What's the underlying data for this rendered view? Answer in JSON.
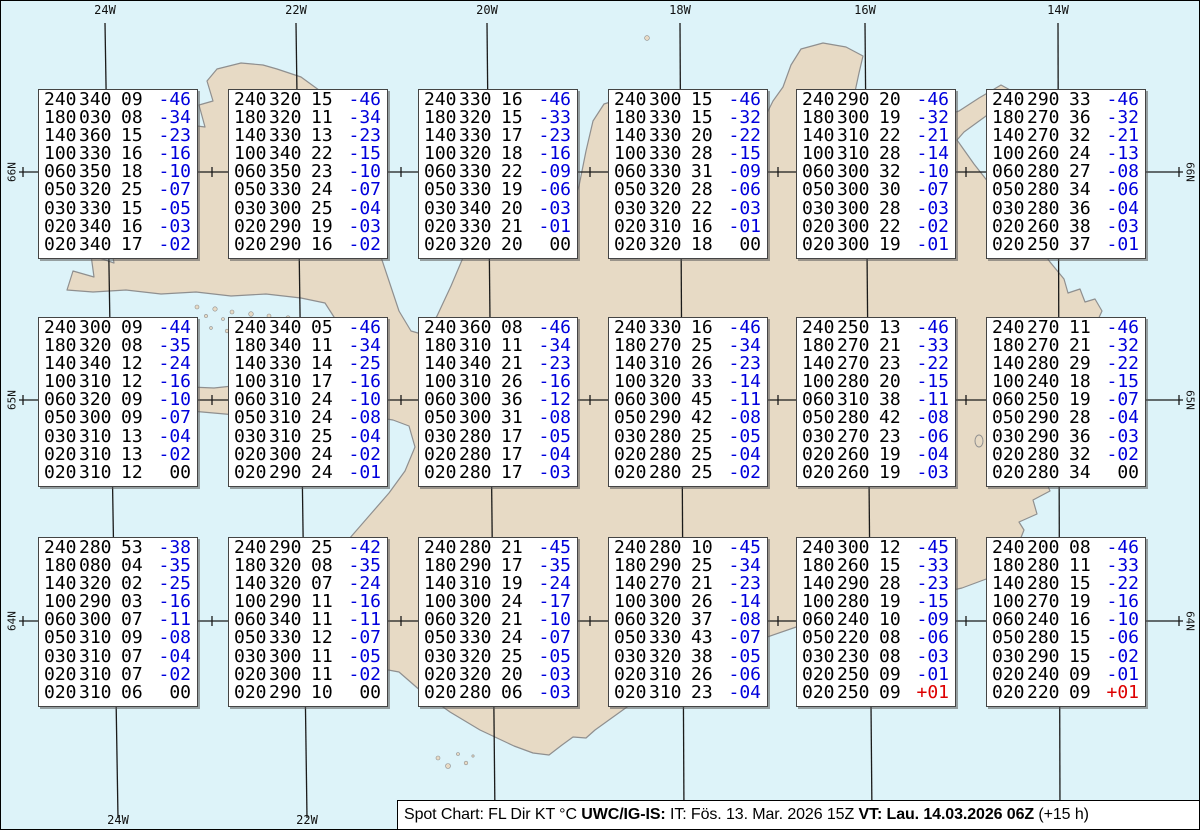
{
  "title": "Spot Chart: FL Dir KT °C",
  "colors": {
    "ocean": "#ddf3f9",
    "land": "#e7dac5",
    "coast": "#8f8f8f",
    "graticule": "#1a1a1a",
    "temp_negative": "#0000dd",
    "temp_positive": "#dd0000",
    "box_background": "#ffffff"
  },
  "graticule_labels": {
    "top": [
      "24W",
      "22W",
      "20W",
      "18W",
      "16W",
      "14W"
    ],
    "bottom": [
      "24W",
      "22W"
    ],
    "left": [
      "66N",
      "65N",
      "64N"
    ],
    "right": [
      "66N",
      "65N",
      "64N"
    ]
  },
  "status_bar": {
    "segments": [
      {
        "text": "Spot Chart: FL Dir KT °C ",
        "bold": false
      },
      {
        "text": "UWC/IG-IS:",
        "bold": true
      },
      {
        "text": " IT: Fös. 13. Mar. 2026 15Z ",
        "bold": false
      },
      {
        "text": "VT: Lau. 14.03.2026 06Z",
        "bold": true
      },
      {
        "text": " (+15 h)",
        "bold": false
      }
    ]
  },
  "chart_data": {
    "type": "table",
    "title": "Spot Chart: FL Dir KT °C",
    "columns": [
      "FL",
      "Dir",
      "KT",
      "TempC"
    ],
    "grid": {
      "columns": 6,
      "rows": 3
    },
    "spots": [
      {
        "lines": [
          [
            "240",
            "340",
            "09",
            "-46"
          ],
          [
            "180",
            "030",
            "08",
            "-34"
          ],
          [
            "140",
            "360",
            "15",
            "-23"
          ],
          [
            "100",
            "330",
            "16",
            "-16"
          ],
          [
            "060",
            "350",
            "18",
            "-10"
          ],
          [
            "050",
            "320",
            "25",
            "-07"
          ],
          [
            "030",
            "330",
            "15",
            "-05"
          ],
          [
            "020",
            "340",
            "16",
            "-03"
          ],
          [
            "020",
            "340",
            "17",
            "-02"
          ]
        ]
      },
      {
        "lines": [
          [
            "240",
            "320",
            "15",
            "-46"
          ],
          [
            "180",
            "320",
            "11",
            "-34"
          ],
          [
            "140",
            "330",
            "13",
            "-23"
          ],
          [
            "100",
            "340",
            "22",
            "-15"
          ],
          [
            "060",
            "350",
            "23",
            "-10"
          ],
          [
            "050",
            "330",
            "24",
            "-07"
          ],
          [
            "030",
            "300",
            "25",
            "-04"
          ],
          [
            "020",
            "290",
            "19",
            "-03"
          ],
          [
            "020",
            "290",
            "16",
            "-02"
          ]
        ]
      },
      {
        "lines": [
          [
            "240",
            "330",
            "16",
            "-46"
          ],
          [
            "180",
            "320",
            "15",
            "-33"
          ],
          [
            "140",
            "330",
            "17",
            "-23"
          ],
          [
            "100",
            "320",
            "18",
            "-16"
          ],
          [
            "060",
            "330",
            "22",
            "-09"
          ],
          [
            "050",
            "330",
            "19",
            "-06"
          ],
          [
            "030",
            "340",
            "20",
            "-03"
          ],
          [
            "020",
            "330",
            "21",
            "-01"
          ],
          [
            "020",
            "320",
            "20",
            "00"
          ]
        ]
      },
      {
        "lines": [
          [
            "240",
            "300",
            "15",
            "-46"
          ],
          [
            "180",
            "330",
            "15",
            "-32"
          ],
          [
            "140",
            "330",
            "20",
            "-22"
          ],
          [
            "100",
            "330",
            "28",
            "-15"
          ],
          [
            "060",
            "330",
            "31",
            "-09"
          ],
          [
            "050",
            "320",
            "28",
            "-06"
          ],
          [
            "030",
            "320",
            "22",
            "-03"
          ],
          [
            "020",
            "310",
            "16",
            "-01"
          ],
          [
            "020",
            "320",
            "18",
            "00"
          ]
        ]
      },
      {
        "lines": [
          [
            "240",
            "290",
            "20",
            "-46"
          ],
          [
            "180",
            "300",
            "19",
            "-32"
          ],
          [
            "140",
            "310",
            "22",
            "-21"
          ],
          [
            "100",
            "310",
            "28",
            "-14"
          ],
          [
            "060",
            "300",
            "32",
            "-10"
          ],
          [
            "050",
            "300",
            "30",
            "-07"
          ],
          [
            "030",
            "300",
            "28",
            "-03"
          ],
          [
            "020",
            "300",
            "22",
            "-02"
          ],
          [
            "020",
            "300",
            "19",
            "-01"
          ]
        ]
      },
      {
        "lines": [
          [
            "240",
            "290",
            "33",
            "-46"
          ],
          [
            "180",
            "270",
            "36",
            "-32"
          ],
          [
            "140",
            "270",
            "32",
            "-21"
          ],
          [
            "100",
            "260",
            "24",
            "-13"
          ],
          [
            "060",
            "280",
            "27",
            "-08"
          ],
          [
            "050",
            "280",
            "34",
            "-06"
          ],
          [
            "030",
            "280",
            "36",
            "-04"
          ],
          [
            "020",
            "260",
            "38",
            "-03"
          ],
          [
            "020",
            "250",
            "37",
            "-01"
          ]
        ]
      },
      {
        "lines": [
          [
            "240",
            "300",
            "09",
            "-44"
          ],
          [
            "180",
            "320",
            "08",
            "-35"
          ],
          [
            "140",
            "340",
            "12",
            "-24"
          ],
          [
            "100",
            "310",
            "12",
            "-16"
          ],
          [
            "060",
            "320",
            "09",
            "-10"
          ],
          [
            "050",
            "300",
            "09",
            "-07"
          ],
          [
            "030",
            "310",
            "13",
            "-04"
          ],
          [
            "020",
            "310",
            "13",
            "-02"
          ],
          [
            "020",
            "310",
            "12",
            "00"
          ]
        ]
      },
      {
        "lines": [
          [
            "240",
            "340",
            "05",
            "-46"
          ],
          [
            "180",
            "340",
            "11",
            "-34"
          ],
          [
            "140",
            "330",
            "14",
            "-25"
          ],
          [
            "100",
            "310",
            "17",
            "-16"
          ],
          [
            "060",
            "310",
            "24",
            "-10"
          ],
          [
            "050",
            "310",
            "24",
            "-08"
          ],
          [
            "030",
            "310",
            "25",
            "-04"
          ],
          [
            "020",
            "300",
            "24",
            "-02"
          ],
          [
            "020",
            "290",
            "24",
            "-01"
          ]
        ]
      },
      {
        "lines": [
          [
            "240",
            "360",
            "08",
            "-46"
          ],
          [
            "180",
            "310",
            "11",
            "-34"
          ],
          [
            "140",
            "340",
            "21",
            "-23"
          ],
          [
            "100",
            "310",
            "26",
            "-16"
          ],
          [
            "060",
            "300",
            "36",
            "-12"
          ],
          [
            "050",
            "300",
            "31",
            "-08"
          ],
          [
            "030",
            "280",
            "17",
            "-05"
          ],
          [
            "020",
            "280",
            "17",
            "-04"
          ],
          [
            "020",
            "280",
            "17",
            "-03"
          ]
        ]
      },
      {
        "lines": [
          [
            "240",
            "330",
            "16",
            "-46"
          ],
          [
            "180",
            "270",
            "25",
            "-34"
          ],
          [
            "140",
            "310",
            "26",
            "-23"
          ],
          [
            "100",
            "320",
            "33",
            "-14"
          ],
          [
            "060",
            "300",
            "45",
            "-11"
          ],
          [
            "050",
            "290",
            "42",
            "-08"
          ],
          [
            "030",
            "280",
            "25",
            "-05"
          ],
          [
            "020",
            "280",
            "25",
            "-04"
          ],
          [
            "020",
            "280",
            "25",
            "-02"
          ]
        ]
      },
      {
        "lines": [
          [
            "240",
            "250",
            "13",
            "-46"
          ],
          [
            "180",
            "270",
            "21",
            "-33"
          ],
          [
            "140",
            "270",
            "23",
            "-22"
          ],
          [
            "100",
            "280",
            "20",
            "-15"
          ],
          [
            "060",
            "310",
            "38",
            "-11"
          ],
          [
            "050",
            "280",
            "42",
            "-08"
          ],
          [
            "030",
            "270",
            "23",
            "-06"
          ],
          [
            "020",
            "260",
            "19",
            "-04"
          ],
          [
            "020",
            "260",
            "19",
            "-03"
          ]
        ]
      },
      {
        "lines": [
          [
            "240",
            "270",
            "11",
            "-46"
          ],
          [
            "180",
            "270",
            "21",
            "-32"
          ],
          [
            "140",
            "280",
            "29",
            "-22"
          ],
          [
            "100",
            "240",
            "18",
            "-15"
          ],
          [
            "060",
            "250",
            "19",
            "-07"
          ],
          [
            "050",
            "290",
            "28",
            "-04"
          ],
          [
            "030",
            "290",
            "36",
            "-03"
          ],
          [
            "020",
            "280",
            "32",
            "-02"
          ],
          [
            "020",
            "280",
            "34",
            "00"
          ]
        ]
      },
      {
        "lines": [
          [
            "240",
            "280",
            "53",
            "-38"
          ],
          [
            "180",
            "080",
            "04",
            "-35"
          ],
          [
            "140",
            "320",
            "02",
            "-25"
          ],
          [
            "100",
            "290",
            "03",
            "-16"
          ],
          [
            "060",
            "300",
            "07",
            "-11"
          ],
          [
            "050",
            "310",
            "09",
            "-08"
          ],
          [
            "030",
            "310",
            "07",
            "-04"
          ],
          [
            "020",
            "310",
            "07",
            "-02"
          ],
          [
            "020",
            "310",
            "06",
            "00"
          ]
        ]
      },
      {
        "lines": [
          [
            "240",
            "290",
            "25",
            "-42"
          ],
          [
            "180",
            "320",
            "08",
            "-35"
          ],
          [
            "140",
            "320",
            "07",
            "-24"
          ],
          [
            "100",
            "290",
            "11",
            "-16"
          ],
          [
            "060",
            "340",
            "11",
            "-11"
          ],
          [
            "050",
            "330",
            "12",
            "-07"
          ],
          [
            "030",
            "300",
            "11",
            "-05"
          ],
          [
            "020",
            "300",
            "11",
            "-02"
          ],
          [
            "020",
            "290",
            "10",
            "00"
          ]
        ]
      },
      {
        "lines": [
          [
            "240",
            "280",
            "21",
            "-45"
          ],
          [
            "180",
            "290",
            "17",
            "-35"
          ],
          [
            "140",
            "310",
            "19",
            "-24"
          ],
          [
            "100",
            "300",
            "24",
            "-17"
          ],
          [
            "060",
            "320",
            "21",
            "-10"
          ],
          [
            "050",
            "330",
            "24",
            "-07"
          ],
          [
            "030",
            "320",
            "25",
            "-05"
          ],
          [
            "020",
            "320",
            "20",
            "-03"
          ],
          [
            "020",
            "280",
            "06",
            "-03"
          ]
        ]
      },
      {
        "lines": [
          [
            "240",
            "280",
            "10",
            "-45"
          ],
          [
            "180",
            "290",
            "25",
            "-34"
          ],
          [
            "140",
            "270",
            "21",
            "-23"
          ],
          [
            "100",
            "300",
            "26",
            "-14"
          ],
          [
            "060",
            "320",
            "37",
            "-08"
          ],
          [
            "050",
            "330",
            "43",
            "-07"
          ],
          [
            "030",
            "320",
            "38",
            "-05"
          ],
          [
            "020",
            "310",
            "26",
            "-06"
          ],
          [
            "020",
            "310",
            "23",
            "-04"
          ]
        ]
      },
      {
        "lines": [
          [
            "240",
            "300",
            "12",
            "-45"
          ],
          [
            "180",
            "260",
            "15",
            "-33"
          ],
          [
            "140",
            "290",
            "28",
            "-23"
          ],
          [
            "100",
            "280",
            "19",
            "-15"
          ],
          [
            "060",
            "240",
            "10",
            "-09"
          ],
          [
            "050",
            "220",
            "08",
            "-06"
          ],
          [
            "030",
            "230",
            "08",
            "-03"
          ],
          [
            "020",
            "250",
            "09",
            "-01"
          ],
          [
            "020",
            "250",
            "09",
            "+01"
          ]
        ]
      },
      {
        "lines": [
          [
            "240",
            "200",
            "08",
            "-46"
          ],
          [
            "180",
            "280",
            "11",
            "-33"
          ],
          [
            "140",
            "280",
            "15",
            "-22"
          ],
          [
            "100",
            "270",
            "19",
            "-16"
          ],
          [
            "060",
            "240",
            "16",
            "-10"
          ],
          [
            "050",
            "280",
            "15",
            "-06"
          ],
          [
            "030",
            "290",
            "15",
            "-02"
          ],
          [
            "020",
            "240",
            "09",
            "-01"
          ],
          [
            "020",
            "220",
            "09",
            "+01"
          ]
        ]
      }
    ]
  }
}
